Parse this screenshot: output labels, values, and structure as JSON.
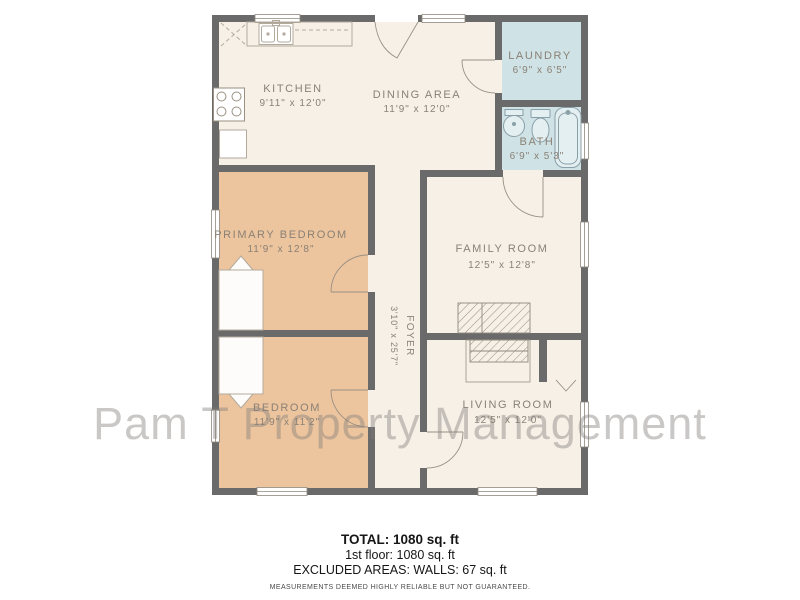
{
  "watermark": "Pam T Property Management",
  "palette": {
    "wall": "#6a6a6a",
    "floor": "#f6f0e7",
    "bedroom": "#ecc49e",
    "wet": "#cfe2e6",
    "label": "#8b8175",
    "fixture_line": "#b3aa9c"
  },
  "floorplan": {
    "rooms": [
      {
        "id": "kitchen",
        "name": "KITCHEN",
        "dims": "9'11\" x 12'0\""
      },
      {
        "id": "dining-area",
        "name": "DINING AREA",
        "dims": "11'9\" x 12'0\""
      },
      {
        "id": "laundry",
        "name": "LAUNDRY",
        "dims": "6'9\" x 6'5\""
      },
      {
        "id": "bath",
        "name": "BATH",
        "dims": "6'9\" x 5'3\""
      },
      {
        "id": "primary-bedroom",
        "name": "PRIMARY BEDROOM",
        "dims": "11'9\" x 12'8\""
      },
      {
        "id": "family-room",
        "name": "FAMILY ROOM",
        "dims": "12'5\" x 12'8\""
      },
      {
        "id": "foyer",
        "name": "FOYER",
        "dims": "3'10\" x 25'7\""
      },
      {
        "id": "bedroom",
        "name": "BEDROOM",
        "dims": "11'9\" x 11'2\""
      },
      {
        "id": "living-room",
        "name": "LIVING ROOM",
        "dims": "12'5\" x 12'0\""
      }
    ]
  },
  "summary": {
    "total": "TOTAL: 1080 sq. ft",
    "floor1": "1st floor: 1080 sq. ft",
    "excluded": "EXCLUDED AREAS: WALLS: 67 sq. ft",
    "disclaimer": "MEASUREMENTS DEEMED HIGHLY RELIABLE BUT NOT GUARANTEED."
  }
}
